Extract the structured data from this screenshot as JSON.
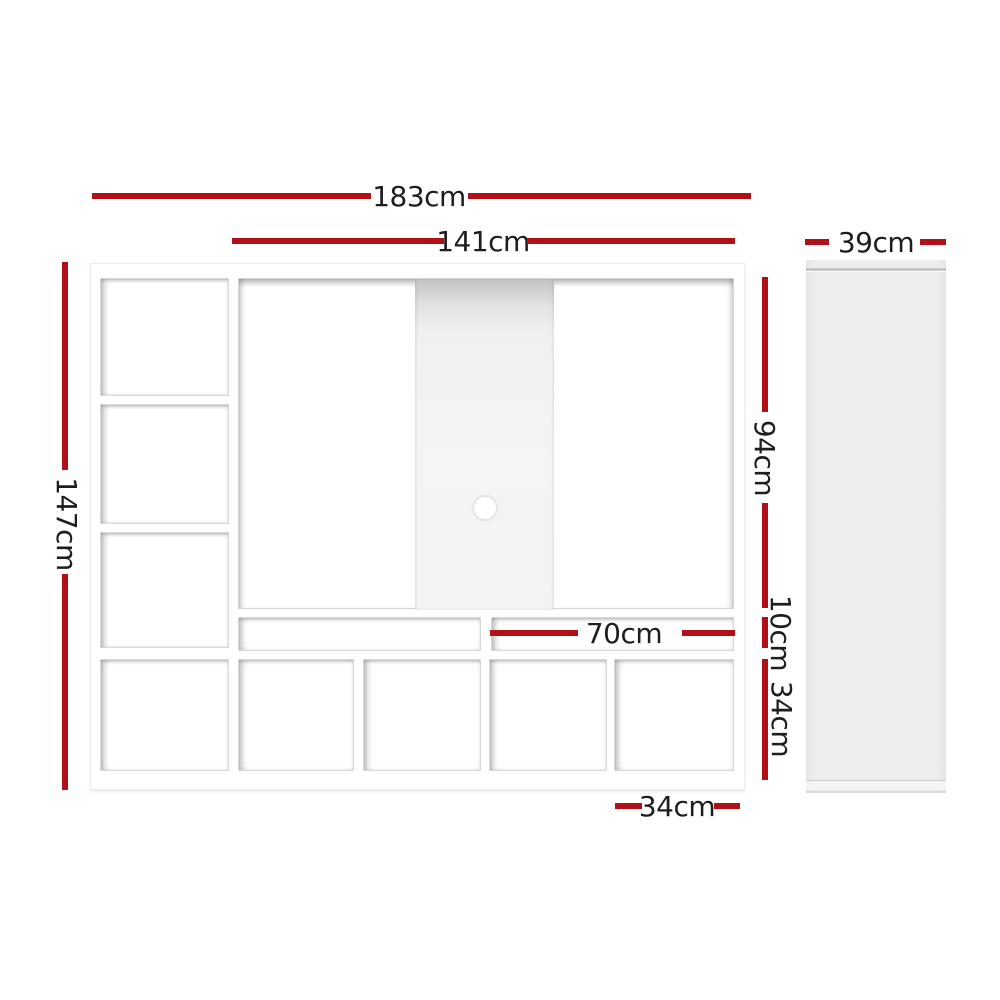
{
  "diagram": {
    "title": "TV entertainment wall unit dimension diagram",
    "front": {
      "overall_width": "183cm",
      "tv_opening_width": "141cm",
      "overall_height": "147cm",
      "tv_opening_height": "94cm",
      "media_shelf_height": "10cm",
      "cubby_row_height": "34cm",
      "media_shelf_width": "70cm",
      "cubby_width": "34cm"
    },
    "side": {
      "depth": "39cm"
    },
    "colors": {
      "dimension_line": "#b01016",
      "dimension_text": "#1e1e1e",
      "side_panel_gray": "#ececec",
      "back_panel_gray": "#f0f0f0"
    }
  }
}
